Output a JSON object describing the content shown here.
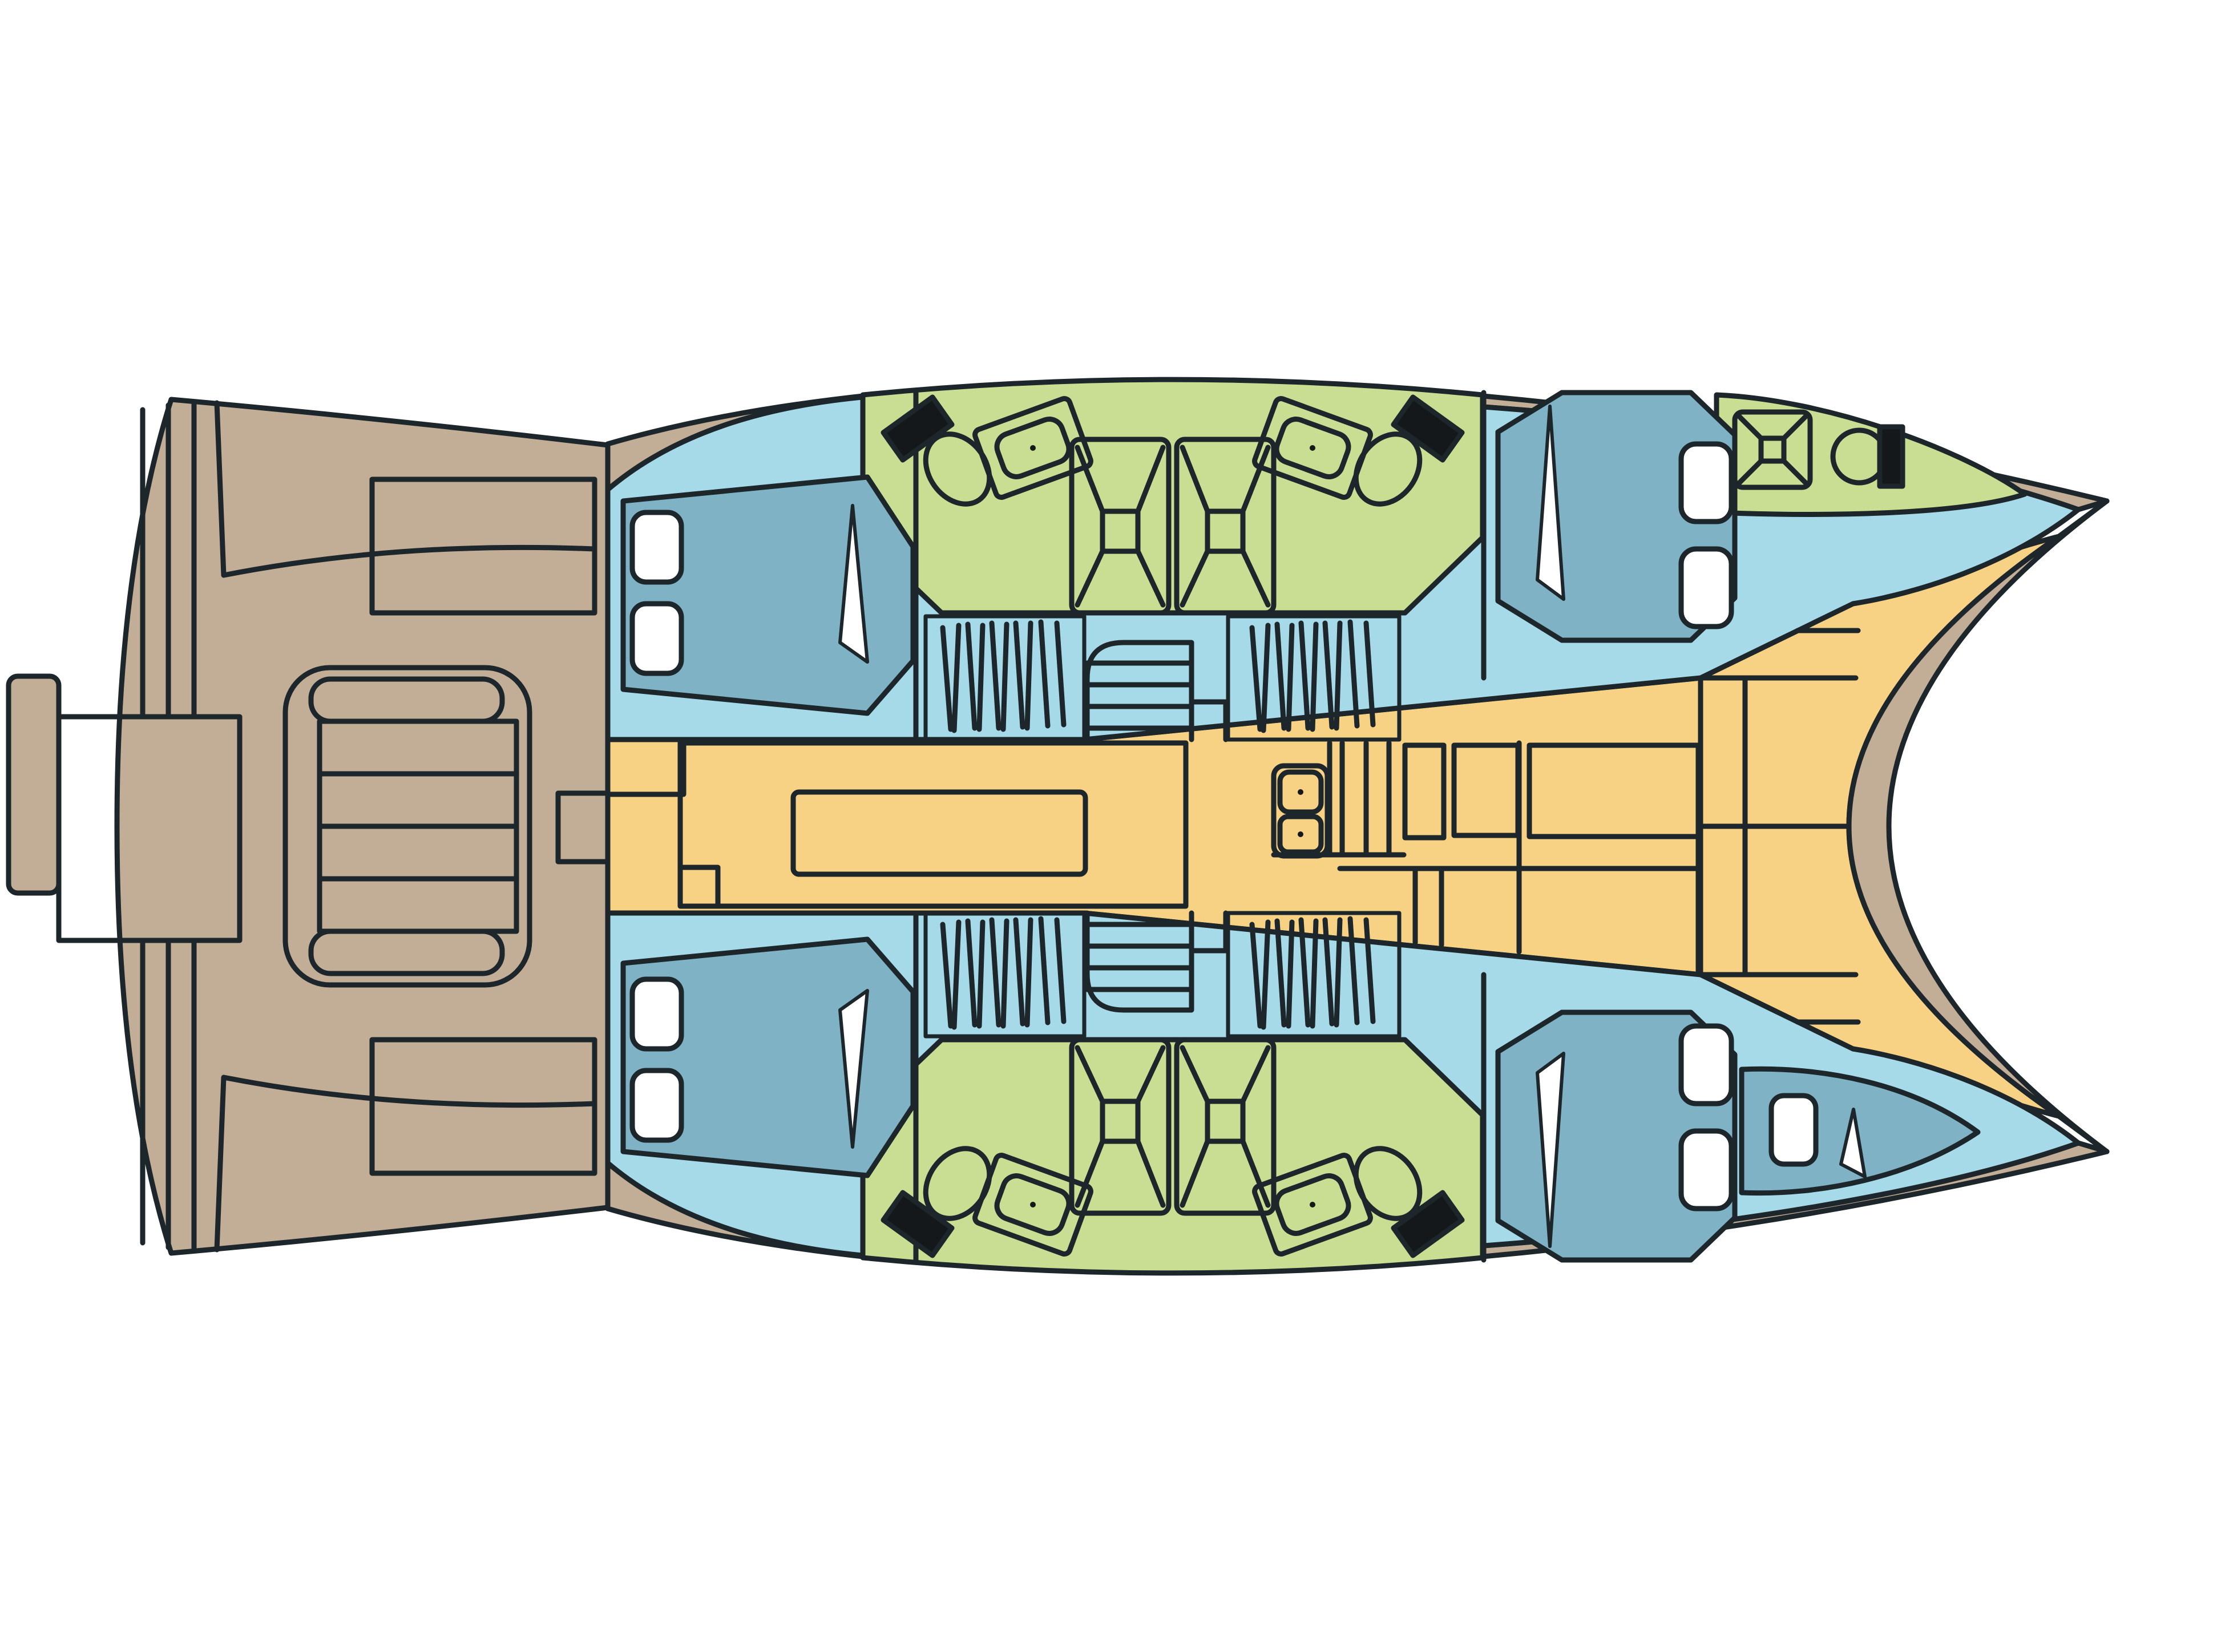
{
  "page": {
    "title": "Catamaran interior deck plan"
  },
  "colors": {
    "background": "#FFFFFF",
    "deck": "#C2AD96",
    "hull_interior": "#A6DAE8",
    "berth": "#7FB2C4",
    "wet_room": "#C8DE92",
    "living": "#F8D284",
    "window": "#FFFFFF",
    "fixture_black": "#14181B",
    "outline": "#1C262B"
  },
  "plan": {
    "vessel_type": "catamaran",
    "view": "top-down deck plan",
    "orientation_bow": "right",
    "areas": [
      {
        "id": "aft-cockpit",
        "label": "Aft cockpit with central sunpad and benches"
      },
      {
        "id": "salon",
        "label": "Salon with L-shaped sofa and table"
      },
      {
        "id": "galley",
        "label": "Galley with double sink and cabinets"
      },
      {
        "id": "port-aft-cabin",
        "label": "Port aft double cabin"
      },
      {
        "id": "port-head",
        "label": "Port bathroom with twin showers, two toilets and two basins"
      },
      {
        "id": "port-fwd-cabin",
        "label": "Port forward double cabin"
      },
      {
        "id": "port-bow-head",
        "label": "Port bow bathroom with shower and toilet"
      },
      {
        "id": "stbd-aft-cabin",
        "label": "Starboard aft double cabin"
      },
      {
        "id": "stbd-head",
        "label": "Starboard bathroom with twin showers, two toilets and two basins"
      },
      {
        "id": "stbd-fwd-cabin",
        "label": "Starboard forward double cabin"
      },
      {
        "id": "stbd-bow-berth",
        "label": "Starboard bow berth"
      },
      {
        "id": "foredeck",
        "label": "Solid foredeck panels"
      }
    ],
    "fixtures": {
      "double_berths": 4,
      "bow_berths": 1,
      "shower_trays": 5,
      "toilets": 5,
      "wash_basins": 4,
      "galley_sinks": 2,
      "wardrobes": 4,
      "companionway_stairs": 2,
      "hull_windows": 9,
      "cockpit_benches": 2,
      "sunpads": 1
    }
  }
}
